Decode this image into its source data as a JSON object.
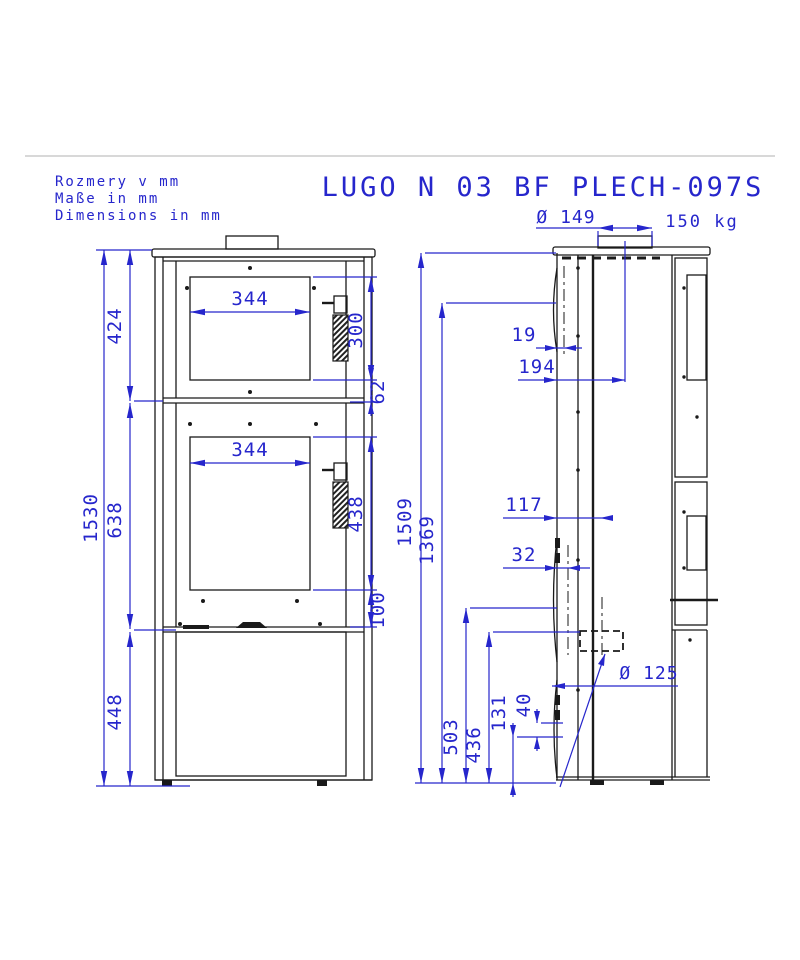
{
  "title": "LUGO N 03 BF PLECH-097S",
  "notes": [
    "Rozmery v mm",
    "Maße in mm",
    "Dimensions in mm"
  ],
  "weight_label": "150 kg",
  "colors": {
    "dimension_blue": "#2626cc",
    "drawing_black": "#1a1a1a",
    "border_gray": "#d8d8d8"
  },
  "front_view": {
    "dimensions": {
      "overall_height": "1530",
      "top_to_divider": "424",
      "upper_window_width": "344",
      "upper_window_height": "300",
      "window_to_divider": "62",
      "middle_section_height": "638",
      "lower_window_width": "344",
      "lower_window_height": "438",
      "window_to_door_bottom": "100",
      "base_compartment_height": "448"
    }
  },
  "side_view": {
    "dimensions": {
      "top_flue_diameter": "Ø 149",
      "body_height": "1509",
      "flue_axis_height": "1369",
      "door_bulge_depth": "19",
      "flue_axis_from_front": "194",
      "rear_outlet_axis_from_front": "117",
      "slot_depth": "32",
      "rear_outlet_axis_height": "503",
      "rear_outlet_bottom_height": "436",
      "vent_slot_bottom_height": "131",
      "vent_slot_height": "40",
      "rear_flue_diameter": "Ø 125"
    }
  }
}
